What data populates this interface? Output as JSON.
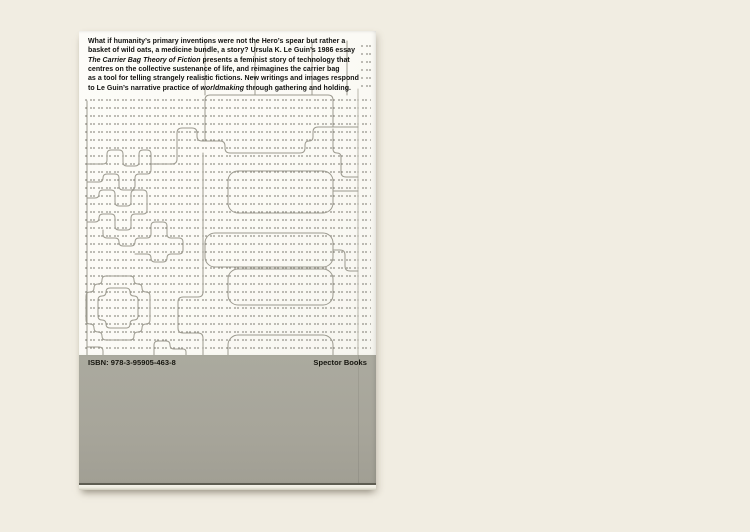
{
  "photo": {
    "backdrop_color": "#f1ede2",
    "cover_color": "#fbfaf5",
    "band_color": "#a7a59a",
    "line_color": "#9c9a8f",
    "dot_color": "#6c6a60"
  },
  "blurb": {
    "lines": [
      [
        {
          "text": "What if humanity’s primary inventions were not the Hero’s spear but rather a",
          "italic": false
        }
      ],
      [
        {
          "text": "basket of wild oats, a medicine bundle, a story? Ursula K. Le Guin’s 1986 essay",
          "italic": false
        }
      ],
      [
        {
          "text": "The Carrier Bag Theory of Fiction",
          "italic": true
        },
        {
          "text": " presents a feminist story of technology that",
          "italic": false
        }
      ],
      [
        {
          "text": "centres on the collective sustenance of life, and reimagines the carrier bag",
          "italic": false
        }
      ],
      [
        {
          "text": "as a tool for telling strangely realistic fictions. New writings and images respond",
          "italic": false
        }
      ],
      [
        {
          "text": "to Le Guin’s narrative practice of ",
          "italic": false
        },
        {
          "text": "worldmaking",
          "italic": true
        },
        {
          "text": " through gathering and holding.",
          "italic": false
        }
      ]
    ]
  },
  "band": {
    "isbn": "ISBN: 978‑3‑95905‑463‑8",
    "publisher": "Spector Books"
  },
  "artwork": {
    "strokes": [
      {
        "name": "left-rule",
        "r": 0,
        "points": [
          [
            8,
            70
          ],
          [
            8,
            324
          ]
        ]
      },
      {
        "name": "spine-crease",
        "r": 0,
        "color": "#bab8ad",
        "points": [
          [
            279,
            58
          ],
          [
            279,
            324
          ]
        ]
      },
      {
        "name": "vessel-shelf",
        "r": 5,
        "points": [
          [
            72,
            133
          ],
          [
            98,
            133
          ],
          [
            98,
            97
          ],
          [
            118,
            97
          ],
          [
            118,
            110
          ],
          [
            146,
            110
          ],
          [
            146,
            122
          ],
          [
            226,
            122
          ],
          [
            226,
            110
          ],
          [
            234,
            110
          ],
          [
            234,
            96
          ],
          [
            279,
            96
          ]
        ]
      },
      {
        "name": "vessel-top",
        "r": 5,
        "points": [
          [
            126,
            110
          ],
          [
            126,
            64
          ],
          [
            254,
            64
          ],
          [
            254,
            96
          ]
        ]
      },
      {
        "name": "stair-to-crease",
        "r": 5,
        "points": [
          [
            254,
            98
          ],
          [
            254,
            122
          ],
          [
            262,
            122
          ],
          [
            262,
            146
          ],
          [
            279,
            146
          ]
        ]
      },
      {
        "name": "text-tick-1",
        "r": 0,
        "points": [
          [
            126,
            10
          ],
          [
            126,
            64
          ]
        ]
      },
      {
        "name": "text-tick-2",
        "r": 0,
        "points": [
          [
            176,
            10
          ],
          [
            176,
            64
          ]
        ]
      },
      {
        "name": "text-tick-3",
        "r": 0,
        "points": [
          [
            233,
            10
          ],
          [
            233,
            64
          ]
        ]
      },
      {
        "name": "text-tick-4",
        "r": 0,
        "points": [
          [
            268,
            10
          ],
          [
            268,
            64
          ]
        ]
      },
      {
        "name": "maze-1",
        "r": 4,
        "points": [
          [
            8,
            133
          ],
          [
            28,
            133
          ],
          [
            28,
            119
          ],
          [
            44,
            119
          ],
          [
            44,
            135
          ],
          [
            60,
            135
          ],
          [
            60,
            119
          ],
          [
            72,
            119
          ],
          [
            72,
            143
          ],
          [
            56,
            143
          ],
          [
            56,
            159
          ],
          [
            40,
            159
          ],
          [
            40,
            143
          ],
          [
            24,
            143
          ],
          [
            24,
            151
          ],
          [
            8,
            151
          ]
        ]
      },
      {
        "name": "maze-2",
        "r": 4,
        "points": [
          [
            8,
            167
          ],
          [
            20,
            167
          ],
          [
            20,
            159
          ],
          [
            36,
            159
          ],
          [
            36,
            175
          ],
          [
            52,
            175
          ],
          [
            52,
            159
          ],
          [
            68,
            159
          ],
          [
            68,
            183
          ],
          [
            52,
            183
          ],
          [
            52,
            199
          ],
          [
            36,
            199
          ],
          [
            36,
            183
          ],
          [
            20,
            183
          ],
          [
            20,
            191
          ],
          [
            8,
            191
          ]
        ]
      },
      {
        "name": "maze-3",
        "r": 4,
        "points": [
          [
            24,
            199
          ],
          [
            24,
            207
          ],
          [
            40,
            207
          ],
          [
            40,
            215
          ],
          [
            56,
            215
          ],
          [
            56,
            207
          ],
          [
            72,
            207
          ],
          [
            72,
            191
          ],
          [
            88,
            191
          ],
          [
            88,
            207
          ],
          [
            104,
            207
          ],
          [
            104,
            223
          ],
          [
            88,
            223
          ],
          [
            88,
            231
          ],
          [
            72,
            231
          ],
          [
            72,
            223
          ],
          [
            56,
            223
          ]
        ]
      },
      {
        "name": "medallion-outer",
        "r": 6,
        "points": [
          [
            39,
            245
          ],
          [
            55,
            245
          ],
          [
            55,
            253
          ],
          [
            63,
            253
          ],
          [
            63,
            261
          ],
          [
            71,
            261
          ],
          [
            71,
            293
          ],
          [
            63,
            293
          ],
          [
            63,
            301
          ],
          [
            55,
            301
          ],
          [
            55,
            309
          ],
          [
            23,
            309
          ],
          [
            23,
            301
          ],
          [
            15,
            301
          ],
          [
            15,
            293
          ],
          [
            7,
            293
          ],
          [
            7,
            261
          ],
          [
            15,
            261
          ],
          [
            15,
            253
          ],
          [
            23,
            253
          ],
          [
            23,
            245
          ],
          [
            39,
            245
          ]
        ]
      },
      {
        "name": "medallion-inner",
        "r": 6,
        "points": [
          [
            39,
            257
          ],
          [
            51,
            257
          ],
          [
            51,
            265
          ],
          [
            59,
            265
          ],
          [
            59,
            289
          ],
          [
            51,
            289
          ],
          [
            51,
            297
          ],
          [
            27,
            297
          ],
          [
            27,
            289
          ],
          [
            19,
            289
          ],
          [
            19,
            265
          ],
          [
            27,
            265
          ],
          [
            27,
            257
          ],
          [
            39,
            257
          ]
        ]
      },
      {
        "name": "notched-vertical",
        "r": 5,
        "points": [
          [
            124,
            122
          ],
          [
            124,
            266
          ],
          [
            99,
            266
          ],
          [
            99,
            302
          ],
          [
            124,
            302
          ],
          [
            124,
            324
          ]
        ]
      },
      {
        "name": "connector-right-1",
        "r": 5,
        "points": [
          [
            254,
            160
          ],
          [
            279,
            160
          ]
        ]
      },
      {
        "name": "connector-right-2",
        "r": 5,
        "points": [
          [
            254,
            219
          ],
          [
            266,
            219
          ],
          [
            266,
            240
          ],
          [
            279,
            240
          ]
        ]
      },
      {
        "name": "bottom-piece-1",
        "r": 4,
        "points": [
          [
            75,
            324
          ],
          [
            75,
            310
          ],
          [
            91,
            310
          ],
          [
            91,
            318
          ],
          [
            107,
            318
          ],
          [
            107,
            324
          ]
        ]
      },
      {
        "name": "bottom-piece-2",
        "r": 4,
        "points": [
          [
            8,
            316
          ],
          [
            24,
            316
          ],
          [
            24,
            324
          ]
        ]
      }
    ],
    "rects": [
      {
        "name": "bag-rect-1",
        "x": 149,
        "y": 140,
        "w": 105,
        "h": 42,
        "r": 10
      },
      {
        "name": "bag-rect-2",
        "x": 126,
        "y": 202,
        "w": 128,
        "h": 34,
        "r": 10
      },
      {
        "name": "bag-rect-3",
        "x": 149,
        "y": 238,
        "w": 105,
        "h": 36,
        "r": 10
      },
      {
        "name": "bag-rect-4",
        "x": 149,
        "y": 304,
        "w": 105,
        "h": 40,
        "r": 10
      }
    ]
  }
}
